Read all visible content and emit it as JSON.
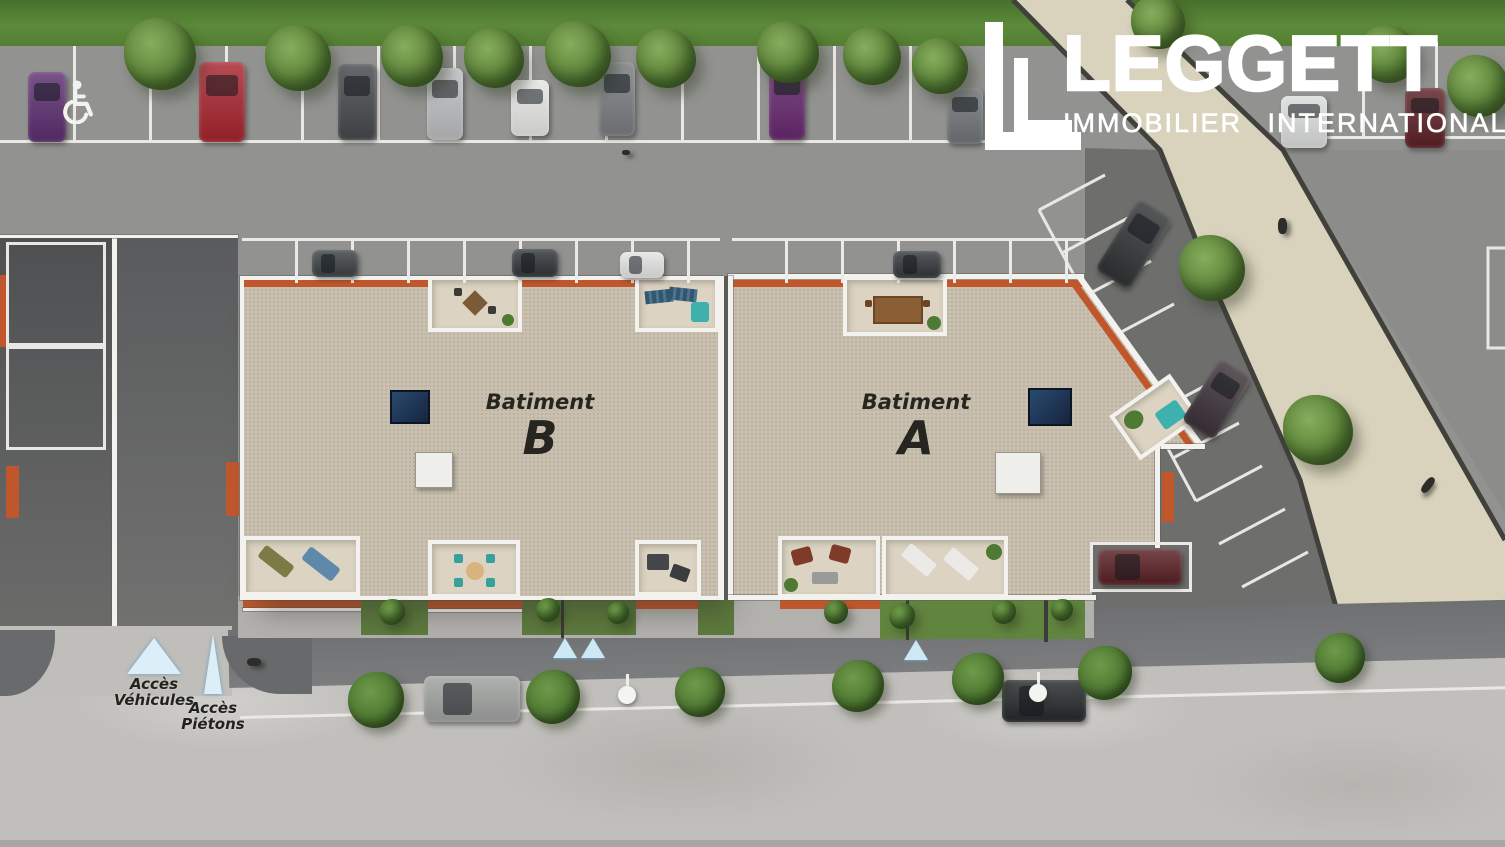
{
  "logo": {
    "name": "LEGGETT",
    "tagline": "IMMOBILIER INTERNATIONAL"
  },
  "buildings": {
    "b": {
      "prefix": "Batiment",
      "letter": "B"
    },
    "a": {
      "prefix": "Batiment",
      "letter": "A"
    }
  },
  "access": {
    "vehicles_l1": "Accès",
    "vehicles_l2": "Véhicules",
    "pedestrians_l1": "Accès",
    "pedestrians_l2": "Piétons"
  },
  "colors": {
    "accent_orange": "#c0572c",
    "roof_tan": "#c9c0af",
    "path_beige": "#d9d2bd",
    "grass_green": "#5d8a3a",
    "marker_blue": "#cfe8f5",
    "logo_white": "#ffffff",
    "asphalt": "#929390",
    "dark_road": "#6e6f6d"
  },
  "icons": [
    "handicap-icon",
    "vehicle-access-triangle-icon",
    "pedestrian-access-triangle-icon",
    "entrance-marker-triangle-icon"
  ],
  "scene": {
    "cars": [
      {
        "x": 28,
        "y": 72,
        "w": 38,
        "h": 70,
        "color": "#5c2d6f",
        "glass": "top"
      },
      {
        "x": 199,
        "y": 62,
        "w": 46,
        "h": 80,
        "color": "#a5242e",
        "glass": "top"
      },
      {
        "x": 338,
        "y": 64,
        "w": 38,
        "h": 76,
        "color": "#45484b",
        "glass": "top"
      },
      {
        "x": 427,
        "y": 68,
        "w": 36,
        "h": 72,
        "color": "#bcbdbf",
        "glass": "top"
      },
      {
        "x": 511,
        "y": 80,
        "w": 38,
        "h": 56,
        "color": "#e6e6e4",
        "glass": "top"
      },
      {
        "x": 599,
        "y": 62,
        "w": 36,
        "h": 74,
        "color": "#797c7f",
        "glass": "top"
      },
      {
        "x": 769,
        "y": 62,
        "w": 36,
        "h": 78,
        "color": "#66286e",
        "glass": "top"
      },
      {
        "x": 947,
        "y": 88,
        "w": 36,
        "h": 56,
        "color": "#707477",
        "glass": "top"
      },
      {
        "x": 1281,
        "y": 96,
        "w": 46,
        "h": 52,
        "color": "#dadcdb",
        "glass": "top"
      },
      {
        "x": 1405,
        "y": 88,
        "w": 40,
        "h": 60,
        "color": "#5b2026",
        "glass": "top"
      },
      {
        "x": 312,
        "y": 250,
        "w": 46,
        "h": 27,
        "color": "#3b3f42",
        "glass": "left"
      },
      {
        "x": 512,
        "y": 249,
        "w": 46,
        "h": 28,
        "color": "#303437",
        "glass": "left"
      },
      {
        "x": 620,
        "y": 252,
        "w": 44,
        "h": 26,
        "color": "#e3e3e1",
        "glass": "left"
      },
      {
        "x": 893,
        "y": 251,
        "w": 48,
        "h": 27,
        "color": "#313539",
        "glass": "left"
      },
      {
        "x": 1114,
        "y": 202,
        "w": 40,
        "h": 84,
        "color": "#2f3234",
        "rot": 32,
        "glass": "top"
      },
      {
        "x": 1198,
        "y": 362,
        "w": 38,
        "h": 74,
        "color": "#3a3136",
        "rot": 32,
        "glass": "top"
      },
      {
        "x": 424,
        "y": 676,
        "w": 96,
        "h": 46,
        "color": "#9fa19f",
        "glass": "left"
      },
      {
        "x": 1002,
        "y": 680,
        "w": 84,
        "h": 42,
        "color": "#25282a",
        "glass": "left"
      },
      {
        "x": 1098,
        "y": 549,
        "w": 84,
        "h": 36,
        "color": "#571e23",
        "glass": "left"
      }
    ],
    "trees": [
      {
        "x": 160,
        "y": 54,
        "r": 36
      },
      {
        "x": 298,
        "y": 58,
        "r": 33
      },
      {
        "x": 412,
        "y": 56,
        "r": 31
      },
      {
        "x": 494,
        "y": 58,
        "r": 30
      },
      {
        "x": 578,
        "y": 54,
        "r": 33
      },
      {
        "x": 666,
        "y": 58,
        "r": 30
      },
      {
        "x": 788,
        "y": 52,
        "r": 31
      },
      {
        "x": 872,
        "y": 56,
        "r": 29
      },
      {
        "x": 940,
        "y": 66,
        "r": 28
      },
      {
        "x": 1158,
        "y": 22,
        "r": 27
      },
      {
        "x": 1388,
        "y": 54,
        "r": 29
      },
      {
        "x": 1478,
        "y": 86,
        "r": 31
      },
      {
        "x": 1212,
        "y": 268,
        "r": 33
      },
      {
        "x": 1318,
        "y": 430,
        "r": 35
      }
    ],
    "shrubs": [
      {
        "x": 376,
        "y": 700,
        "r": 28
      },
      {
        "x": 553,
        "y": 697,
        "r": 27
      },
      {
        "x": 700,
        "y": 692,
        "r": 25
      },
      {
        "x": 858,
        "y": 686,
        "r": 26
      },
      {
        "x": 978,
        "y": 679,
        "r": 26
      },
      {
        "x": 1105,
        "y": 673,
        "r": 27
      },
      {
        "x": 1340,
        "y": 658,
        "r": 25
      }
    ],
    "garden_shrubs": [
      {
        "x": 392,
        "y": 612,
        "r": 13
      },
      {
        "x": 548,
        "y": 610,
        "r": 12
      },
      {
        "x": 618,
        "y": 613,
        "r": 11
      },
      {
        "x": 836,
        "y": 612,
        "r": 12
      },
      {
        "x": 902,
        "y": 616,
        "r": 13
      },
      {
        "x": 1004,
        "y": 612,
        "r": 12
      },
      {
        "x": 1062,
        "y": 610,
        "r": 11
      }
    ],
    "streetlights": [
      {
        "x": 627,
        "y": 686
      },
      {
        "x": 1038,
        "y": 684
      }
    ],
    "figures": [
      {
        "type": "pedestrian",
        "x": 1278,
        "y": 218
      },
      {
        "type": "cyclist",
        "x": 1424,
        "y": 476
      },
      {
        "type": "bird",
        "x": 622,
        "y": 150
      },
      {
        "type": "dog",
        "x": 247,
        "y": 658
      }
    ]
  }
}
